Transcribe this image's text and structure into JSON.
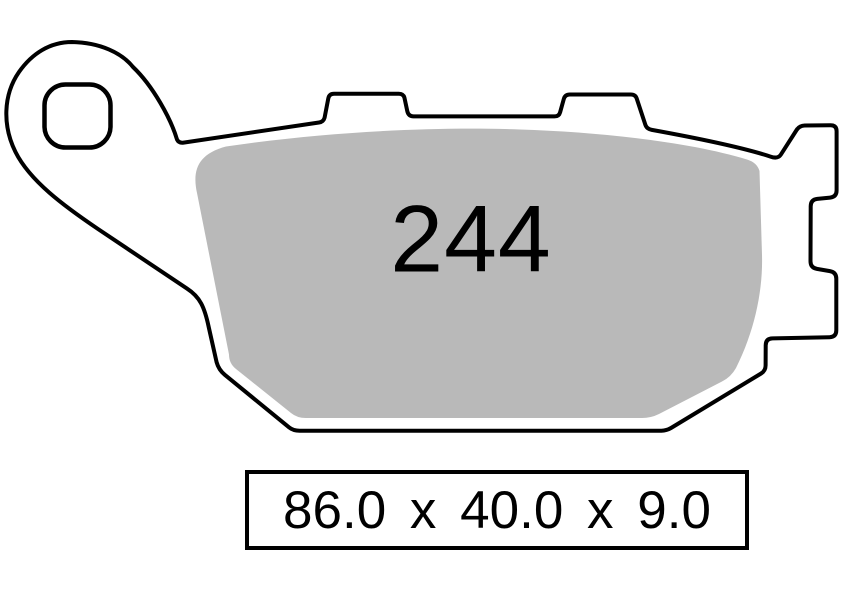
{
  "drawing": {
    "pad_number": "244",
    "dimensions": {
      "display": "86.0 x 40.0 x 9.0",
      "values": [
        "86.0",
        "40.0",
        "9.0"
      ],
      "separator": "x"
    }
  },
  "colors": {
    "outline": "#000000",
    "friction_material": "#b9b9b9",
    "plate_fill": "#ffffff",
    "background": "#ffffff",
    "text": "#000000"
  }
}
